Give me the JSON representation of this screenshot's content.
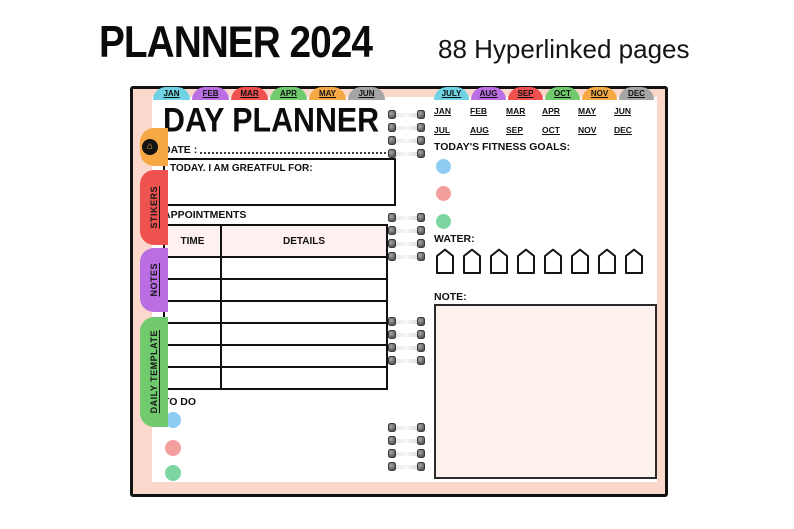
{
  "header": {
    "title": "PLANNER 2024",
    "subtitle": "88 Hyperlinked pages"
  },
  "palette": {
    "cover_peach": "#fbd8cb",
    "tab_cyan": "#6fd3e3",
    "tab_purple": "#bb6ee4",
    "tab_red": "#f0504f",
    "tab_green": "#71cb6e",
    "tab_orange": "#f5a843",
    "tab_gray": "#a5a5a5",
    "dot_blue": "#8fccf3",
    "dot_pink": "#f59e9e",
    "dot_green": "#7dd6a1",
    "box_pink": "#fdf1ee"
  },
  "month_tabs": {
    "left": [
      {
        "label": "JAN",
        "color": "#6fd3e3"
      },
      {
        "label": "FEB",
        "color": "#bb6ee4"
      },
      {
        "label": "MAR",
        "color": "#f0504f"
      },
      {
        "label": "APR",
        "color": "#71cb6e"
      },
      {
        "label": "MAY",
        "color": "#f5a843"
      },
      {
        "label": "JUN",
        "color": "#a5a5a5"
      }
    ],
    "right": [
      {
        "label": "JULY",
        "color": "#6fd3e3"
      },
      {
        "label": "AUG",
        "color": "#bb6ee4"
      },
      {
        "label": "SEP",
        "color": "#f0504f"
      },
      {
        "label": "OCT",
        "color": "#71cb6e"
      },
      {
        "label": "NOV",
        "color": "#f5a843"
      },
      {
        "label": "DEC",
        "color": "#a5a5a5"
      }
    ]
  },
  "side_tabs": {
    "home": {
      "icon": "home-icon",
      "glyph": "⌂",
      "color": "#f5a843"
    },
    "items": [
      {
        "label": "STIKERS",
        "color": "#ef5350"
      },
      {
        "label": "NOTES",
        "color": "#bb6ee4"
      },
      {
        "label": "DAILY TEMPLATE",
        "color": "#71cb6e"
      }
    ]
  },
  "left_page": {
    "title": "DAY PLANNER",
    "date_label": "DATE :",
    "grateful_label": "TODAY. I AM GREATFUL FOR:",
    "appointments_label": "APPOINTMENTS",
    "table": {
      "col_time": "TIME",
      "col_details": "DETAILS",
      "empty_rows": 6
    },
    "todo_label": "TO DO",
    "todo_dots": [
      "#8fccf3",
      "#f59e9e",
      "#7dd6a1"
    ]
  },
  "right_page": {
    "months_row1": [
      "JAN",
      "FEB",
      "MAR",
      "APR",
      "MAY",
      "JUN"
    ],
    "months_row2": [
      "JUL",
      "AUG",
      "SEP",
      "OCT",
      "NOV",
      "DEC"
    ],
    "fitness_label": "TODAY'S FITNESS GOALS:",
    "fitness_dots": [
      "#8fccf3",
      "#f59e9e",
      "#7dd6a1"
    ],
    "water_label": "WATER:",
    "water_cup_count": 8,
    "note_label": "NOTE:"
  }
}
